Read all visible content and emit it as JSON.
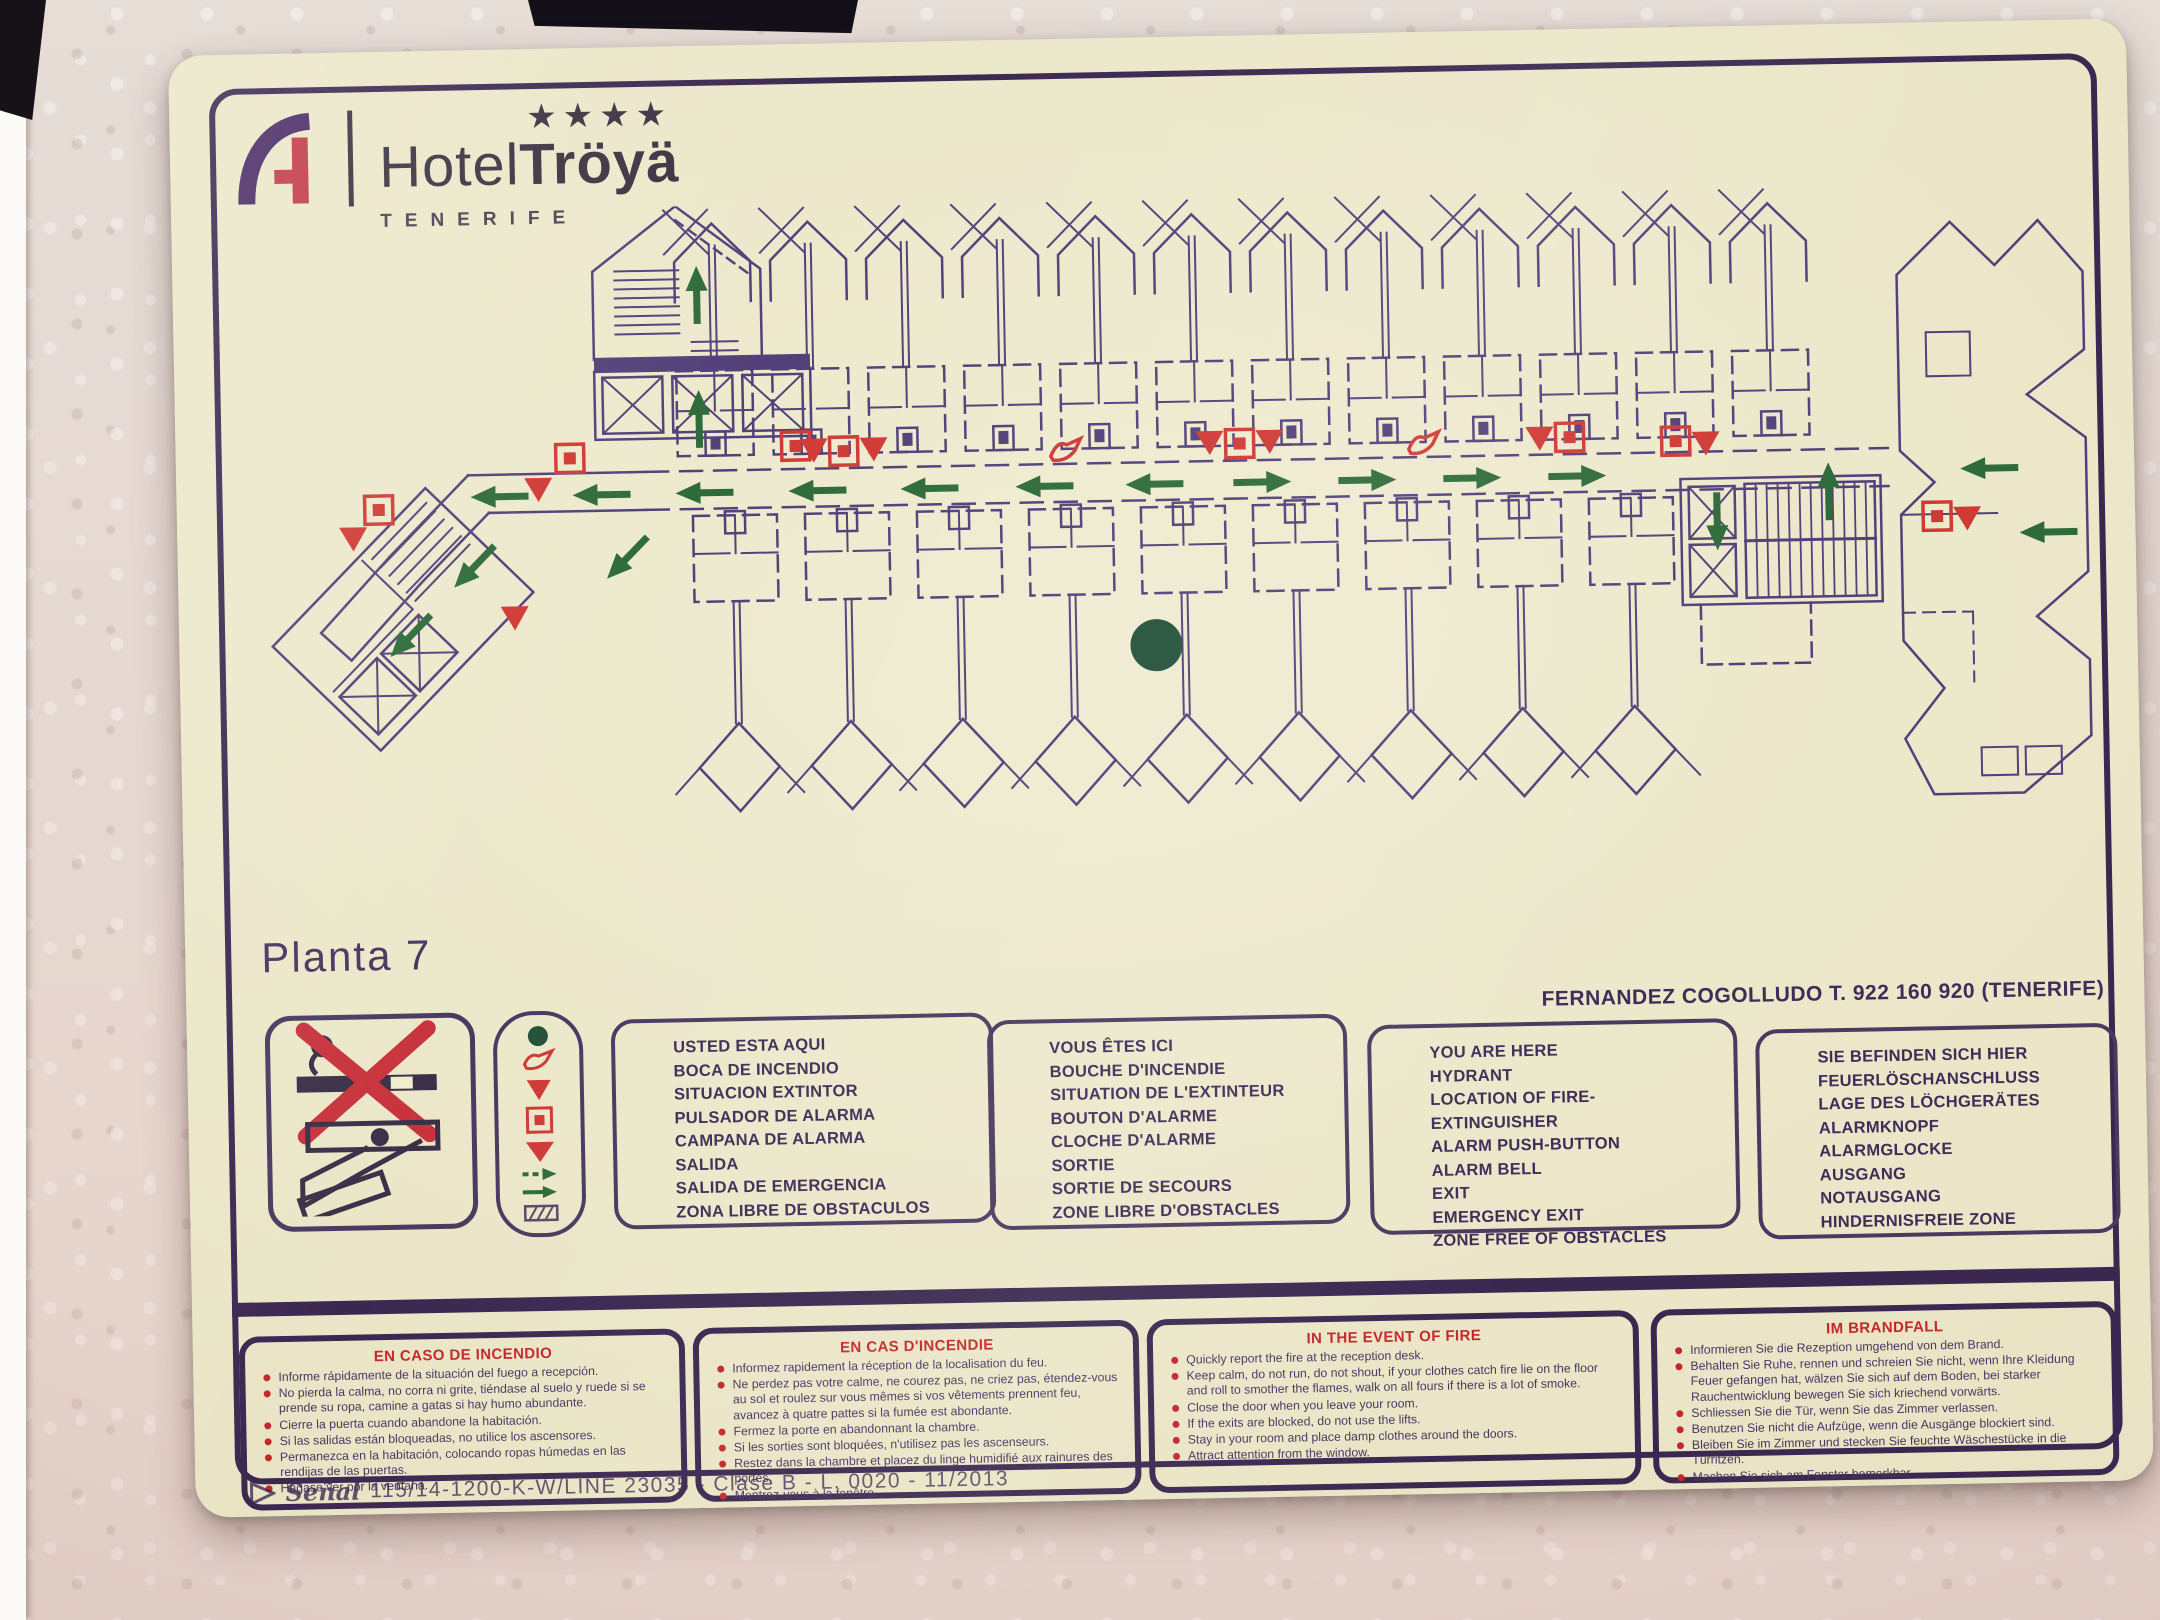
{
  "sign": {
    "brand": {
      "prefix": "Hotel",
      "name": "Tröyä",
      "stars": "★★★★",
      "location": "TENERIFE"
    },
    "floor_label": "Planta 7",
    "contact": "FERNANDEZ COGOLLUDO T. 922 160 920 (TENERIFE)",
    "legend": {
      "es": [
        "USTED ESTA AQUI",
        "BOCA DE INCENDIO",
        "SITUACION EXTINTOR",
        "PULSADOR DE ALARMA",
        "CAMPANA DE ALARMA",
        "SALIDA",
        "SALIDA DE EMERGENCIA",
        "ZONA LIBRE DE OBSTACULOS"
      ],
      "fr": [
        "VOUS ÊTES ICI",
        "BOUCHE D'INCENDIE",
        "SITUATION DE L'EXTINTEUR",
        "BOUTON D'ALARME",
        "CLOCHE D'ALARME",
        "SORTIE",
        "SORTIE DE SECOURS",
        "ZONE LIBRE D'OBSTACLES"
      ],
      "en": [
        "YOU ARE HERE",
        "HYDRANT",
        "LOCATION OF FIRE-EXTINGUISHER",
        "ALARM PUSH-BUTTON",
        "ALARM BELL",
        "EXIT",
        "EMERGENCY EXIT",
        "ZONE FREE OF OBSTACLES"
      ],
      "de": [
        "SIE BEFINDEN SICH HIER",
        "FEUERLÖSCHANSCHLUSS",
        "LAGE DES LÖCHGERÄTES",
        "ALARMKNOPF",
        "ALARMGLOCKE",
        "AUSGANG",
        "NOTAUSGANG",
        "HINDERNISFREIE ZONE"
      ],
      "symbol_icons": [
        "you-are-here-dot",
        "hydrant",
        "fire-extinguisher",
        "alarm-push-button",
        "alarm-bell",
        "exit-route-arrow",
        "emergency-exit-arrow",
        "obstacle-free-zone"
      ]
    },
    "instructions": {
      "es": {
        "title": "EN CASO DE INCENDIO",
        "items": [
          "Informe rápidamente de la situación del fuego a recepción.",
          "No pierda la calma, no corra ni grite, tiéndase al suelo y ruede si se prende su ropa, camine a gatas si hay humo abundante.",
          "Cierre la puerta cuando abandone la habitación.",
          "Si las salidas están bloqueadas, no utilice los ascensores.",
          "Permanezca en la habitación, colocando ropas húmedas en las rendijas de las puertas.",
          "Hágase ver por la ventana."
        ]
      },
      "fr": {
        "title": "EN CAS D'INCENDIE",
        "items": [
          "Informez rapidement la réception de la localisation du feu.",
          "Ne perdez pas votre calme, ne courez pas, ne criez pas, étendez-vous au sol et roulez sur vous mêmes si vos vêtements prennent feu, avancez à quatre pattes si la fumée est abondante.",
          "Fermez la porte en abandonnant la chambre.",
          "Si les sorties sont bloquées, n'utilisez pas les ascenseurs.",
          "Restez dans la chambre et placez du linge humidifié aux rainures des portes.",
          "Montrez-vous à la fenêtre."
        ]
      },
      "en": {
        "title": "IN THE EVENT OF FIRE",
        "items": [
          "Quickly report the fire at the reception desk.",
          "Keep calm, do not run, do not shout, if your clothes catch fire lie on the floor and roll to smother the flames, walk on all fours if there is a lot of smoke.",
          "Close the door when you leave your room.",
          "If the exits are blocked, do not use the lifts.",
          "Stay in your room and place damp clothes around the doors.",
          "Attract attention from the window."
        ]
      },
      "de": {
        "title": "IM BRANDFALL",
        "items": [
          "Informieren Sie die Rezeption umgehend von dem Brand.",
          "Behalten Sie Ruhe, rennen und schreien Sie nicht, wenn Ihre Kleidung Feuer gefangen hat, wälzen Sie sich auf dem Boden, bei starker Rauchentwicklung bewegen Sie sich kriechend vorwärts.",
          "Schliessen Sie die Tür, wenn Sie das Zimmer verlassen.",
          "Benutzen Sie nicht die Aufzüge, wenn die Ausgänge blockiert sind.",
          "Bleiben Sie im Zimmer und stecken Sie feuchte Wäschestücke in die Türritzen.",
          "Machen Sie sich am Fenster bemerkbar."
        ]
      }
    },
    "footer": {
      "maker_script": "Señal",
      "code": "115/14-1200-K-W/LINE 23035 - Clase B - L. 0020 - 11/2013"
    },
    "colors": {
      "cream": "#ece7c9",
      "frame_purple": "#3b2750",
      "plan_purple": "#53407a",
      "alert_red": "#c3272b",
      "route_green": "#2e6b3a",
      "dot_green": "#24523b"
    }
  }
}
